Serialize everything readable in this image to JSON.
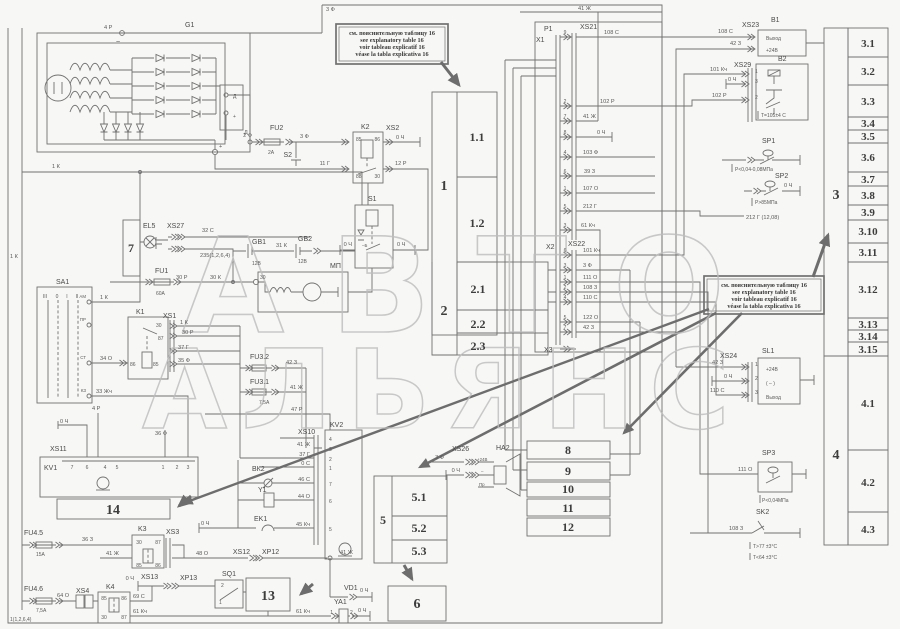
{
  "watermark": {
    "line1": "АВТО",
    "line2": "АЛЬЯНС"
  },
  "note": {
    "l1": "см. пояснительную таблицу 16",
    "l2": "see explanatory table 16",
    "l3": "voir tableau explicatif 16",
    "l4": "véase la tabla explicativa 16"
  },
  "blocks": {
    "b1": "1",
    "b1_1": "1.1",
    "b1_2": "1.2",
    "b2": "2",
    "b2_1": "2.1",
    "b2_2": "2.2",
    "b2_3": "2.3",
    "b3": "3",
    "b3_1": "3.1",
    "b3_2": "3.2",
    "b3_3": "3.3",
    "b3_4": "3.4",
    "b3_5": "3.5",
    "b3_6": "3.6",
    "b3_7": "3.7",
    "b3_8": "3.8",
    "b3_9": "3.9",
    "b3_10": "3.10",
    "b3_11": "3.11",
    "b3_12": "3.12",
    "b3_13": "3.13",
    "b3_14": "3.14",
    "b3_15": "3.15",
    "b4": "4",
    "b4_1": "4.1",
    "b4_2": "4.2",
    "b4_3": "4.3",
    "b5": "5",
    "b5_1": "5.1",
    "b5_2": "5.2",
    "b5_3": "5.3",
    "b6": "6",
    "b7": "7",
    "b8": "8",
    "b9": "9",
    "b10": "10",
    "b11": "11",
    "b12": "12",
    "b13": "13",
    "b14": "14"
  },
  "comp": {
    "g1": "G1",
    "fu1": "FU1",
    "fu2": "FU2",
    "fu3_1": "FU3.1",
    "fu3_2": "FU3.2",
    "fu4_5": "FU4.5",
    "fu4_6": "FU4.6",
    "k1": "K1",
    "k2": "K2",
    "k3": "K3",
    "k4": "K4",
    "s1": "S1",
    "s2": "S2",
    "sa1": "SA1",
    "sq1": "SQ1",
    "el5": "EL5",
    "gb1": "GB1",
    "gb2": "GB2",
    "kv1": "KV1",
    "kv2": "KV2",
    "bk2": "ВК2",
    "y1": "Y1",
    "ek1": "EK1",
    "ya1": "YA1",
    "vd1": "VD1",
    "mp": "МП",
    "ha2": "HA2",
    "b1": "B1",
    "b2": "B2",
    "sp1": "SP1",
    "sp2": "SP2",
    "sp3": "SP3",
    "sk2": "SK2",
    "sl1": "SL1",
    "p1": "P1",
    "x1": "X1",
    "x2": "Х2",
    "x3": "Х3",
    "xs1": "XS1",
    "xs2": "XS2",
    "xs3": "XS3",
    "xs4": "XS4",
    "xs10": "XS10",
    "xs11": "XS11",
    "xs12": "XS12",
    "xs13": "XS13",
    "xp12": "XP12",
    "xp13": "XP13",
    "xs21": "XS21",
    "xs22": "XS22",
    "xs23": "XS23",
    "xs24": "XS24",
    "xs26": "XS26",
    "xs27": "XS27",
    "xs29": "XS29"
  },
  "pins": {
    "n1": "1",
    "n2": "2",
    "n3": "3",
    "n4": "4",
    "n5": "5",
    "n6": "6",
    "n7": "7",
    "n8": "8",
    "n9": "9",
    "n30": "30",
    "n85": "85",
    "n86": "86",
    "n87": "87",
    "n88": "88"
  },
  "wires": {
    "w0ch": "0 Ч",
    "w0s": "0 С",
    "w1k": "1 К",
    "w2f": "2 Ф",
    "w3f": "3 Ф",
    "w4r": "4 Р",
    "w11g": "11 Г",
    "w12r": "12 Р",
    "w30": "30",
    "w30k": "30 К",
    "w30r": "30 Р",
    "w31k": "31 К",
    "w32s": "32 С",
    "w33zh": "33 Жч",
    "w34o": "34 О",
    "w35f": "35 Ф",
    "w36f": "36 Ф",
    "w36z": "36 З",
    "w37g": "37 Г",
    "w39z": "39 З",
    "w41zh": "41 Ж",
    "w42z": "42 З",
    "w44o": "44 О",
    "w45k": "45 Кч",
    "w46s": "46 С",
    "w47r": "47 Р",
    "w48o": "48 О",
    "w61k": "61 Кч",
    "w64o": "64 О",
    "w69s": "69 С",
    "w101k": "101 Кч",
    "w102r": "102 Р",
    "w103f": "103 Ф",
    "w107o": "107 О",
    "w108s": "108 С",
    "w108z": "108 З",
    "w110s": "110 С",
    "w111o": "111 О",
    "w122o": "122 О",
    "w212g": "212 Г"
  },
  "values": {
    "fu1": "60А",
    "fu2": "2А",
    "fu3_1": "7,5А",
    "fu4_5": "15А",
    "fu4_6": "7,5А",
    "gb": "12В",
    "b2_temp": "Т=105±4 С",
    "sp1": "Р<0,04-0,08МПа",
    "sp2": "Р>85МПа",
    "sp3": "Р<0,04МПа",
    "sk2_hi": "Т>77 ±3°С",
    "sk2_lo": "Т<64 ±3°С",
    "w212g_note": "212 Г (12,08)",
    "corner": "1(1,2,6,4)",
    "xs27_note": "235(1,2,6,4)"
  },
  "terminals": {
    "vyhod": "Выход",
    "plus24": "+24В",
    "minus_paren": "( – )",
    "minus": "–",
    "pr": "Пр",
    "d": "Д",
    "plus": "+",
    "b_minus": "–Б",
    "ac": "~"
  },
  "sa1": {
    "pos3": "III",
    "pos0": "0",
    "pos1": "I",
    "pos2": "II",
    "c1": "АМ",
    "c2": "ПР",
    "c3": "СТ",
    "c4": "КЗ"
  }
}
